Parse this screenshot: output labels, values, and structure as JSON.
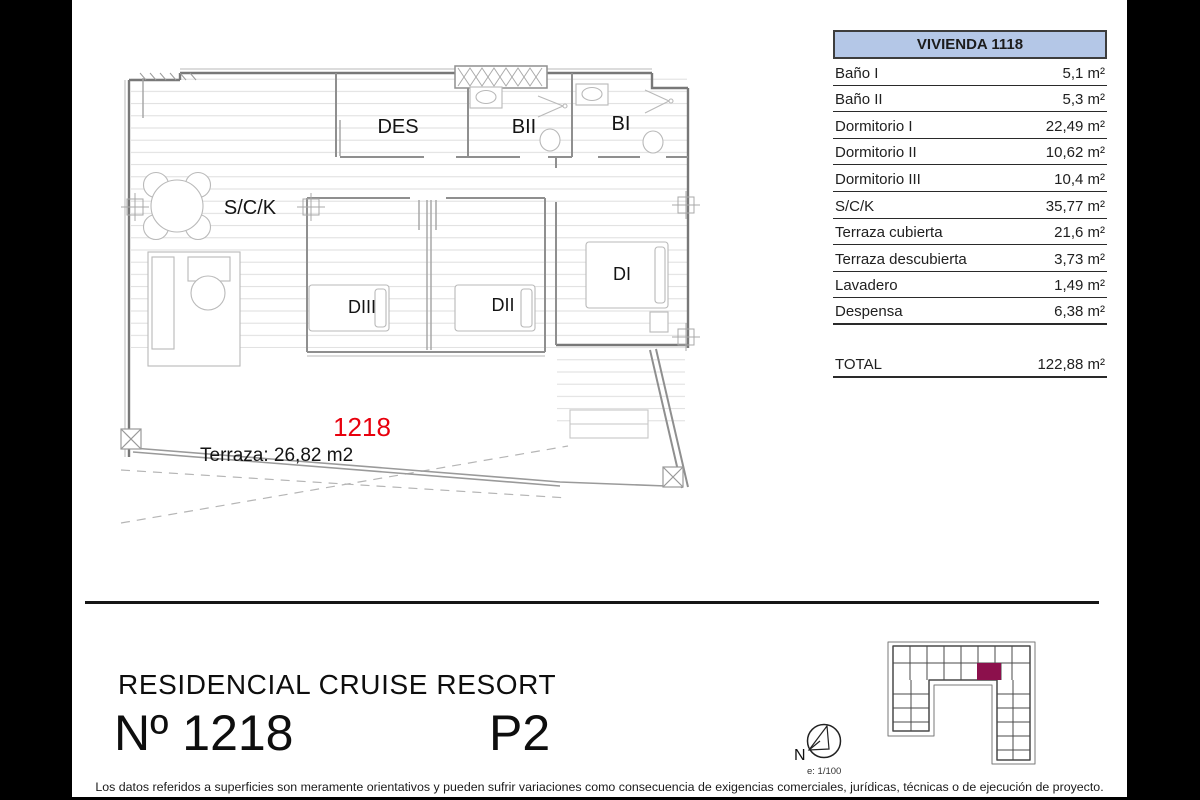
{
  "window": {
    "background": "#000000",
    "paper_color": "#ffffff"
  },
  "area_table": {
    "title": "VIVIENDA 1118",
    "header_bg": "#b4c7e7",
    "rows": [
      {
        "label": "Baño I",
        "value": "5,1 m²"
      },
      {
        "label": "Baño II",
        "value": "5,3 m²"
      },
      {
        "label": "Dormitorio I",
        "value": "22,49 m²"
      },
      {
        "label": "Dormitorio II",
        "value": "10,62 m²"
      },
      {
        "label": "Dormitorio III",
        "value": "10,4 m²"
      },
      {
        "label": "S/C/K",
        "value": "35,77 m²"
      },
      {
        "label": "Terraza cubierta",
        "value": "21,6 m²"
      },
      {
        "label": "Terraza descubierta",
        "value": "3,73 m²"
      },
      {
        "label": "Lavadero",
        "value": "1,49 m²"
      },
      {
        "label": "Despensa",
        "value": "6,38 m²"
      }
    ],
    "total_label": "TOTAL",
    "total_value": "122,88 m²"
  },
  "floor_plan": {
    "labels": {
      "des": "DES",
      "bii": "BII",
      "bi": "BI",
      "sck": "S/C/K",
      "diii": "DIII",
      "dii": "DII",
      "di": "DI"
    },
    "unit_number": "1218",
    "unit_number_color": "#e8000d",
    "terrace_label": "Terraza: 26,82 m2"
  },
  "title_block": {
    "project_name": "RESIDENCIAL CRUISE RESORT",
    "unit_label": "Nº 1218",
    "floor_label": "P2"
  },
  "compass": {
    "north_label": "N",
    "scale_label": "e: 1/100"
  },
  "site_plan": {
    "highlight_color": "#8C104C"
  },
  "footer": {
    "disclaimer": "Los datos referidos a superficies son meramente orientativos y pueden sufrir variaciones como consecuencia de exigencias comerciales, jurídicas, técnicas o de ejecución de proyecto."
  }
}
